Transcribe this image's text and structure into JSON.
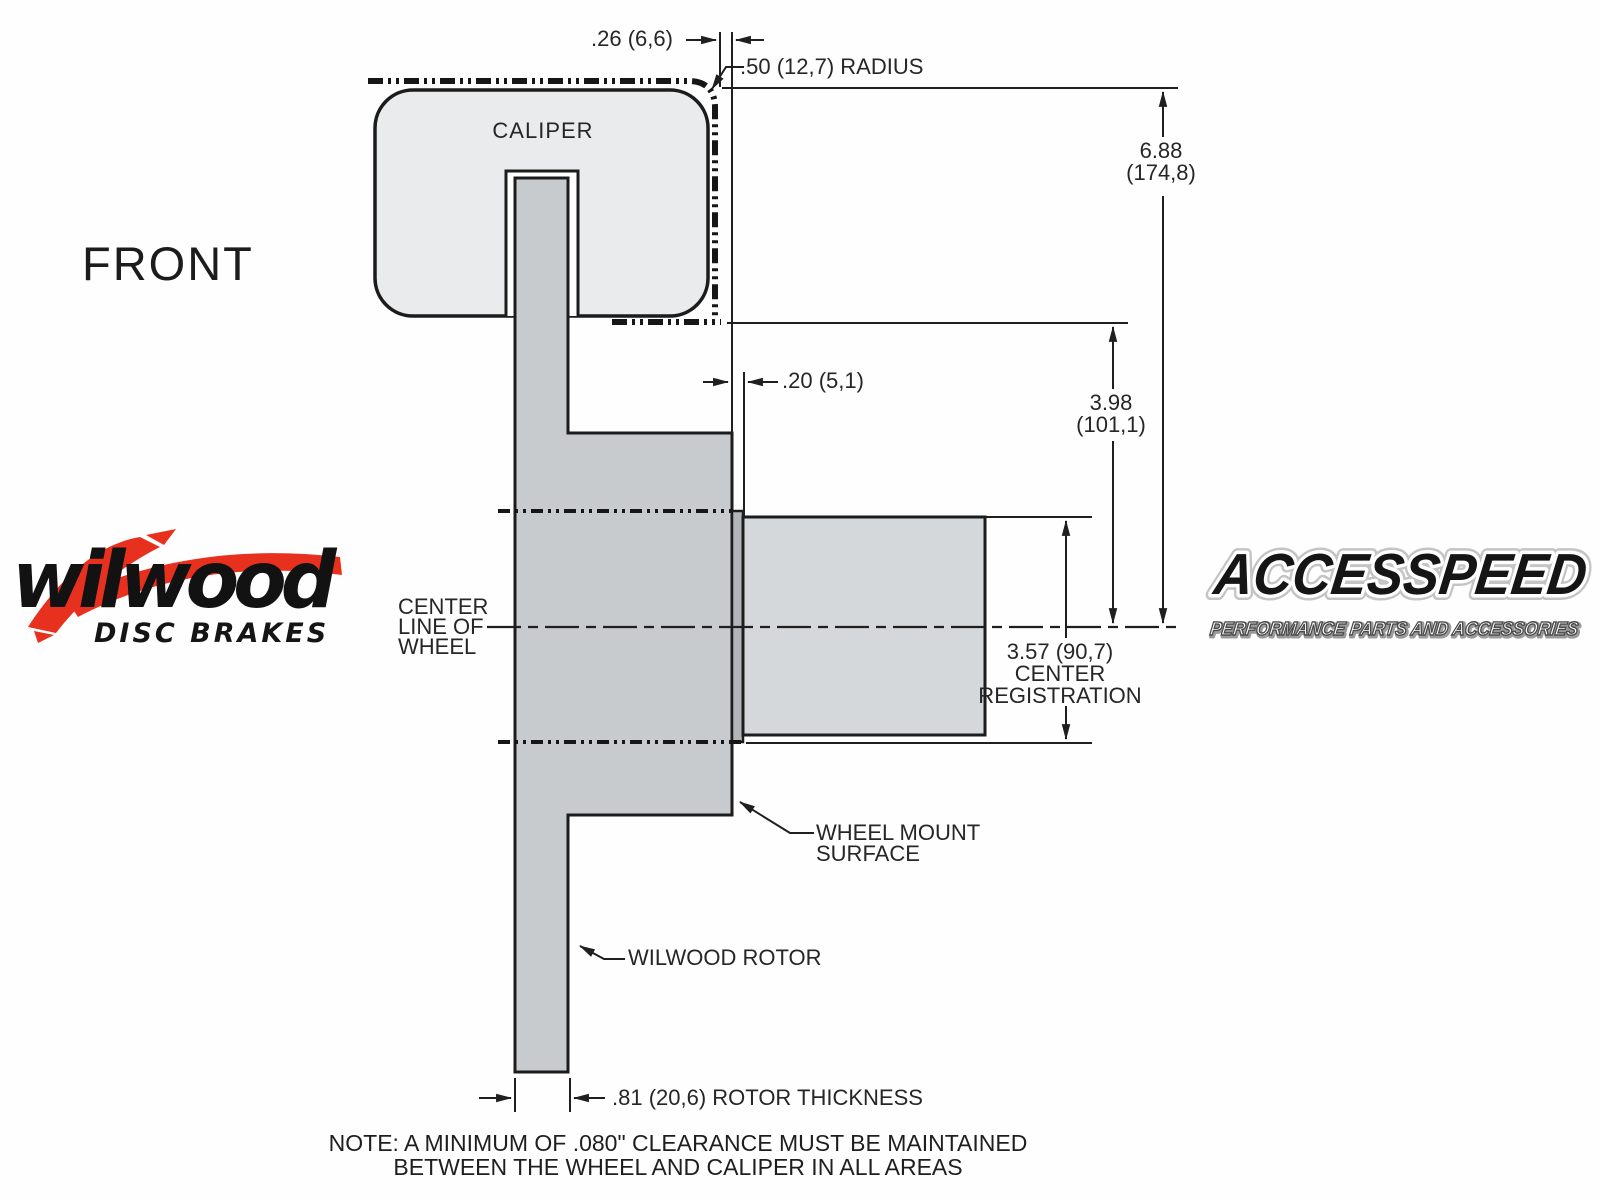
{
  "page": {
    "background": "#fefefe"
  },
  "view_label": "FRONT",
  "caliper": {
    "label": "CALIPER"
  },
  "dims": {
    "offset": ".26 (6,6)",
    "radius": ".50 (12,7) RADIUS",
    "wheel_height": {
      "in": "6.88",
      "mm": "(174,8)"
    },
    "inner_height": {
      "in": "3.98",
      "mm": "(101,1)"
    },
    "protrusion": ".20 (5,1)",
    "registration": {
      "value": "3.57 (90,7)",
      "line2": "CENTER",
      "line3": "REGISTRATION"
    },
    "rotor_thickness": ".81 (20,6) ROTOR THICKNESS"
  },
  "labels": {
    "center_line": {
      "line1": "CENTER",
      "line2": "LINE OF",
      "line3": "WHEEL"
    },
    "wheel_mount": {
      "line1": "WHEEL MOUNT",
      "line2": "SURFACE"
    },
    "rotor": "WILWOOD ROTOR"
  },
  "note": {
    "line1": "NOTE: A MINIMUM OF .080\" CLEARANCE MUST BE MAINTAINED",
    "line2": "BETWEEN THE WHEEL AND CALIPER IN ALL AREAS"
  },
  "logos": {
    "wilwood": {
      "wordmark": "wilwood",
      "tagline": "DISC BRAKES",
      "accent_color": "#e8301f",
      "text_color": "#121212"
    },
    "accesspeed": {
      "wordmark": "ACCESSPEED",
      "tagline": "PERFORMANCE PARTS AND ACCESSORIES"
    }
  },
  "colors": {
    "line": "#1f1f1f",
    "caliper_fill": "#e9ebed",
    "rotor_fill": "#c8cbce",
    "hub_fill": "#d5d8da",
    "register_fill": "#b1b5b8"
  }
}
